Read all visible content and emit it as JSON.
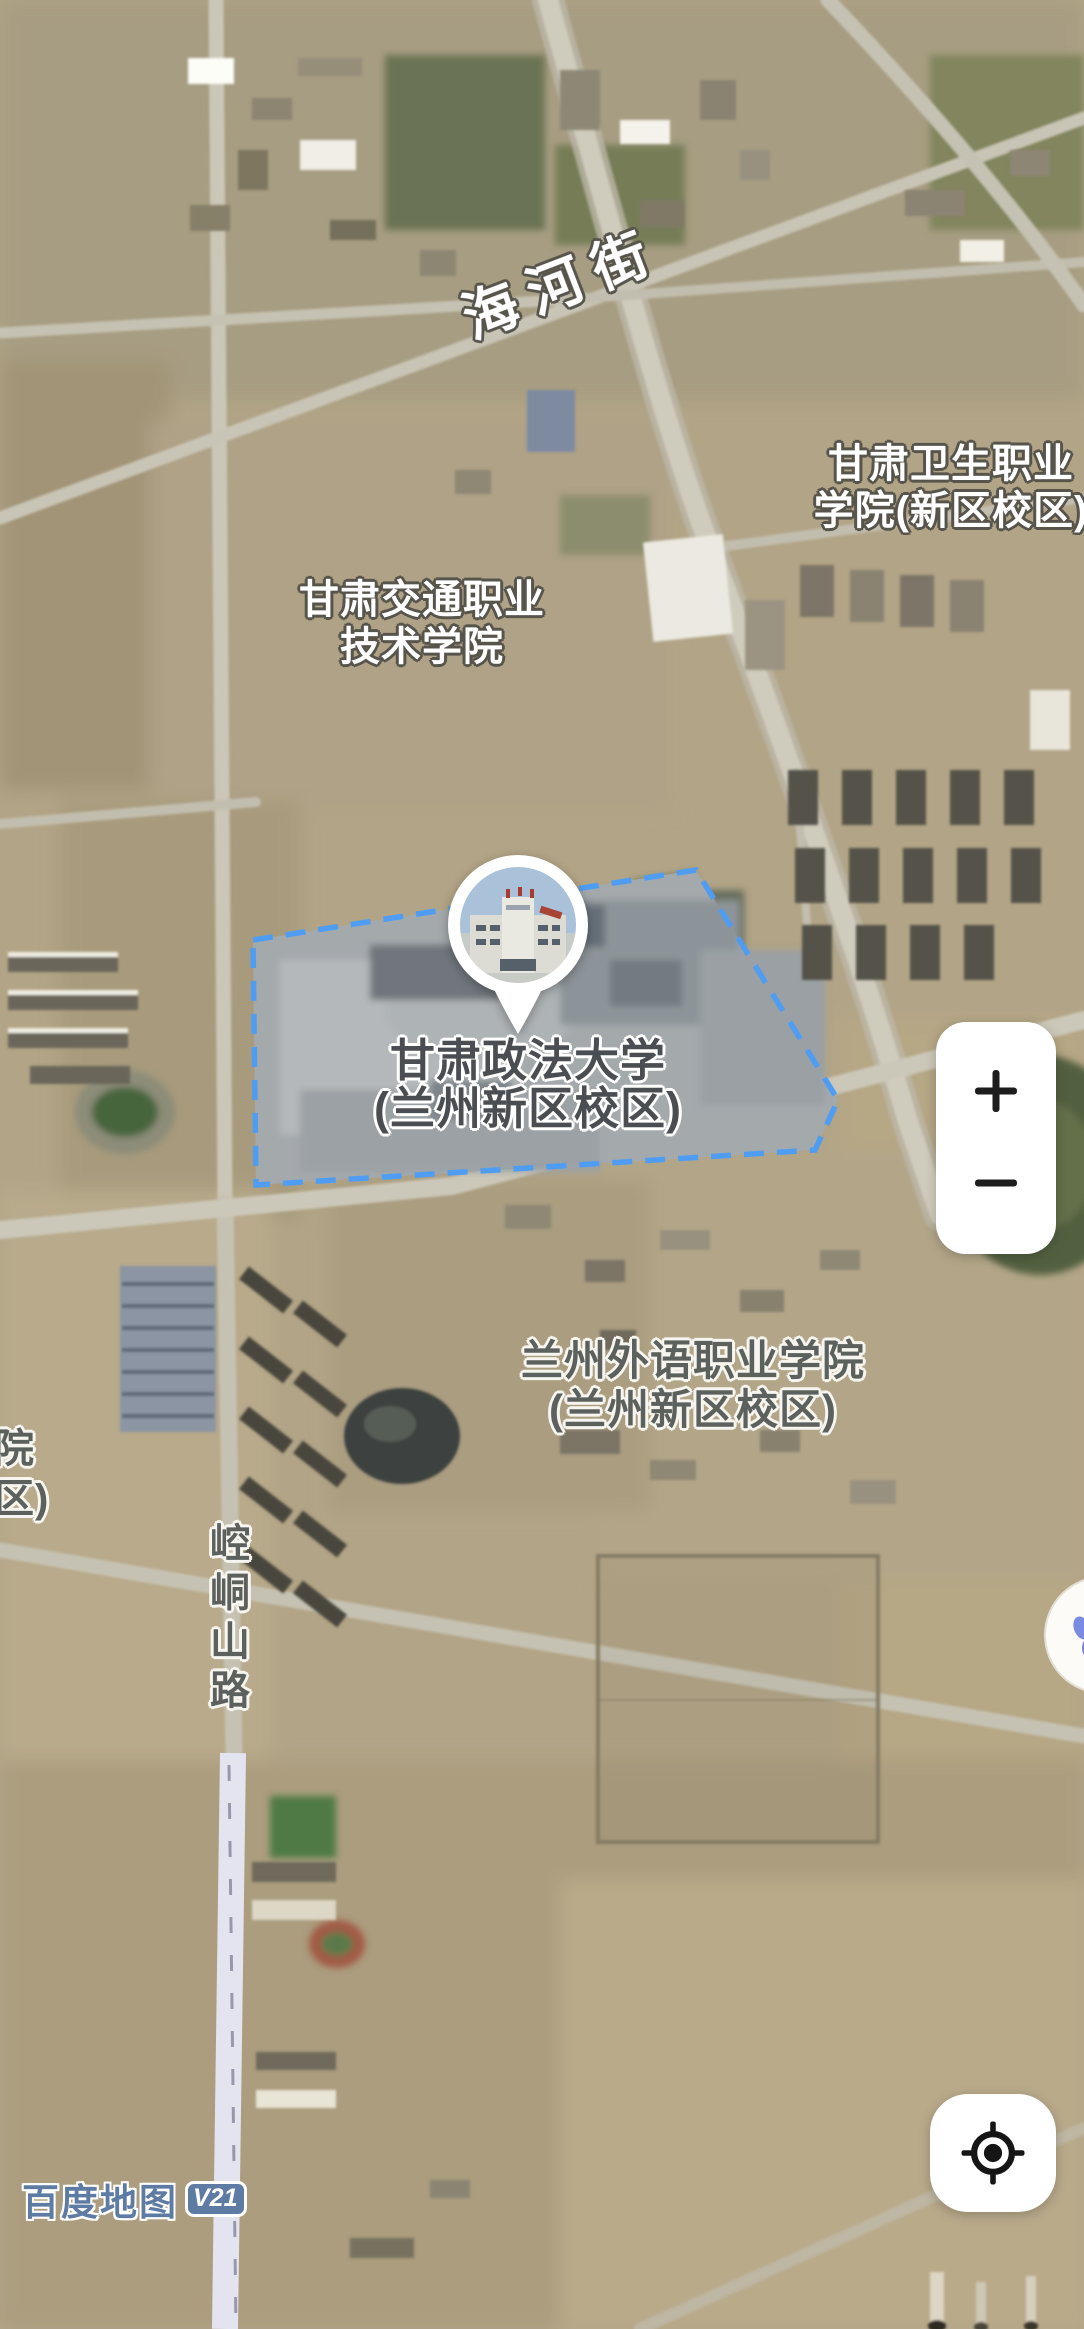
{
  "app": {
    "name": "Baidu Maps satellite view"
  },
  "labels": {
    "road_haihe": "海河街",
    "college_health": {
      "line1": "甘肃卫生职业",
      "line2": "学院(新区校区)"
    },
    "college_jiaotong": {
      "line1": "甘肃交通职业",
      "line2": "技术学院"
    },
    "univ_zhengfa": {
      "line1": "甘肃政法大学",
      "line2": "(兰州新区校区)"
    },
    "college_waiyu": {
      "line1": "兰州外语职业学院",
      "line2": "(兰州新区校区)"
    },
    "road_kongtong": "崆峒山路",
    "partial_label": {
      "line1": "院",
      "line2": "区)"
    }
  },
  "controls": {
    "zoom_in": "+",
    "zoom_out": "−",
    "locate": "locate"
  },
  "watermark": {
    "brand": "百度地图",
    "version": "V21"
  },
  "colors": {
    "boundary_dash": "#4f9df2",
    "watermark_blue": "#5e7ba3",
    "paw_blue": "#6e7fdd",
    "label_outline_dark": "#56544b",
    "label_fill_dark": "#4a4e52"
  }
}
